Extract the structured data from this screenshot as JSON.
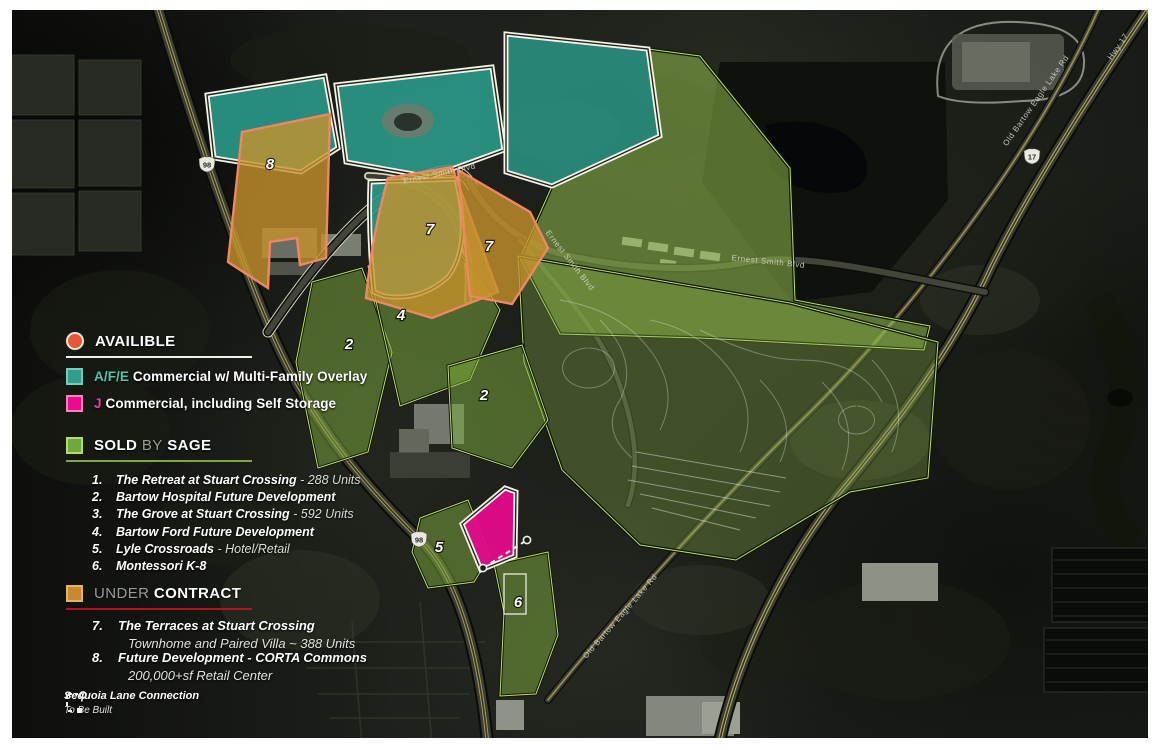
{
  "legend": {
    "available_label": "AVAILIBLE",
    "zoning": [
      {
        "code": "A/F/E",
        "label": "Commercial w/ Multi-Family Overlay",
        "color": "#2f9e8d"
      },
      {
        "code": "J",
        "label": "Commercial, including Self Storage",
        "color": "#ec0b8d"
      }
    ],
    "sold": {
      "prefix": "SOLD",
      "middle": "BY",
      "suffix": "SAGE",
      "color": "#6fa93c"
    },
    "sold_items": [
      {
        "num": "1.",
        "name": "The Retreat at Stuart Crossing",
        "detail": "- 288 Units"
      },
      {
        "num": "2.",
        "name": "Bartow Hospital Future Development",
        "detail": ""
      },
      {
        "num": "3.",
        "name": "The Grove at Stuart Crossing",
        "detail": "- 592 Units"
      },
      {
        "num": "4.",
        "name": "Bartow Ford Future Development",
        "detail": ""
      },
      {
        "num": "5.",
        "name": "Lyle Crossroads",
        "detail": "- Hotel/Retail"
      },
      {
        "num": "6.",
        "name": "Montessori K-8",
        "detail": ""
      }
    ],
    "under_contract": {
      "prefix": "UNDER",
      "suffix": "CONTRACT",
      "color": "#c8882f",
      "underline_color": "#b5121b"
    },
    "contract_items": [
      {
        "num": "7.",
        "name": "The Terraces at Stuart Crossing",
        "detail": "Townhome and Paired Villa ~ 388 Units"
      },
      {
        "num": "8.",
        "name": "Future Development - CORTA Commons",
        "detail": "200,000+sf Retail Center"
      }
    ],
    "sequoia": {
      "line1": "Sequoia Lane Connection",
      "line2": "To Be Built"
    },
    "available_color": "#e8563a"
  },
  "map": {
    "parcel_labels": [
      {
        "text": "8"
      },
      {
        "text": "7"
      },
      {
        "text": "7"
      },
      {
        "text": "4"
      },
      {
        "text": "2"
      },
      {
        "text": "2"
      },
      {
        "text": "5"
      },
      {
        "text": "6"
      }
    ],
    "road_labels": [
      {
        "text": "Ernest Smith Blvd"
      },
      {
        "text": "Ernest Smith Blvd"
      },
      {
        "text": "Ernest Smith Blvd"
      },
      {
        "text": "Old Bartow Eagle Lake Rd"
      },
      {
        "text": "Old Bartow Eagle Lake Rd"
      },
      {
        "text": "Hwy 17"
      }
    ],
    "shields": [
      {
        "route": "98"
      },
      {
        "route": "98"
      },
      {
        "route": "17"
      }
    ]
  }
}
